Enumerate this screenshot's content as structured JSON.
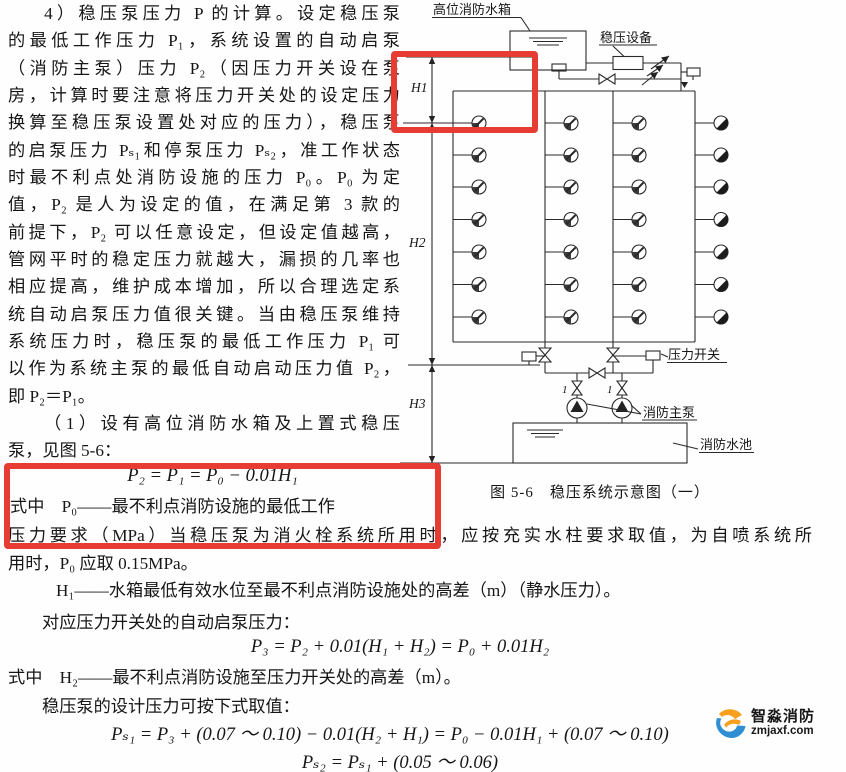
{
  "text": {
    "col_lines": [
      "4）稳压泵压力 P 的计算。设定稳压泵",
      "的最低工作压力 P₁，系统设置的自动启泵",
      "（消防主泵）压力 P₂（因压力开关设在泵",
      "房，计算时要注意将压力开关处的设定压力",
      "换算至稳压泵设置处对应的压力），稳压泵",
      "的启泵压力 Pₛ₁和停泵压力 Pₛ₂，准工作状态",
      "时最不利点处消防设施的压力 P₀。P₀ 为定",
      "值，P₂ 是人为设定的值，在满足第 3 款的",
      "前提下，P₂ 可以任意设定，但设定值越高，",
      "管网平时的稳定压力就越大，漏损的几率也",
      "相应提高，维护成本增加，所以合理选定系",
      "统自动启泵压力值很关键。当由稳压泵维持",
      "系统压力时，稳压泵的最低工作压力 P₁ 可",
      "以作为系统主泵的最低自动启动压力值 P₂，",
      "即 P₂＝P₁。",
      "（1）设有高位消防水箱及上置式稳压",
      "泵，见图 5-6："
    ],
    "formula1": "P₂ = P₁ = P₀ − 0.01H₁",
    "shizhong1": "式中　P₀——最不利点消防设施的最低工作",
    "wide_lines": [
      "压力要求（MPa）当稳压泵为消火栓系统所用时，应按充实水柱要求取值，为自喷系统所",
      "用时，P₀ 应取 0.15MPa。",
      "H₁——水箱最低有效水位至最不利点消防设施处的高差（m）（静水压力）。",
      "对应压力开关处的自动启泵压力："
    ],
    "formula2": "P₃ = P₂ + 0.01(H₁ + H₂) = P₀ + 0.01H₂",
    "shizhong2": "式中　H₂——最不利点消防设施至压力开关处的高差（m）。",
    "line_design": "稳压泵的设计压力可按下式取值：",
    "formula3": "Pₛ₁ = P₃ + (0.07 ～ 0.10) − 0.01(H₂ + H₁) = P₀ − 0.01H₁ + (0.07 ～ 0.10)",
    "formula4": "Pₛ₂ = Pₛ₁ + (0.05 ～ 0.06)"
  },
  "diagram": {
    "caption": "图 5-6　稳压系统示意图（一）",
    "labels": {
      "tank": "高位消防水箱",
      "stabilizer": "稳压设备",
      "pressure_switch": "压力开关",
      "main_pump": "消防主泵",
      "pool": "消防水池",
      "dim1": "H1",
      "dim2": "H2",
      "dim3": "H3",
      "pump_no_left": "1",
      "pump_no_right": "1"
    }
  },
  "annotations": {
    "highlight_color": "#e63c34",
    "box_count": 2
  },
  "watermark": {
    "brand": "智淼消防",
    "site": "zmjaxf.com"
  }
}
